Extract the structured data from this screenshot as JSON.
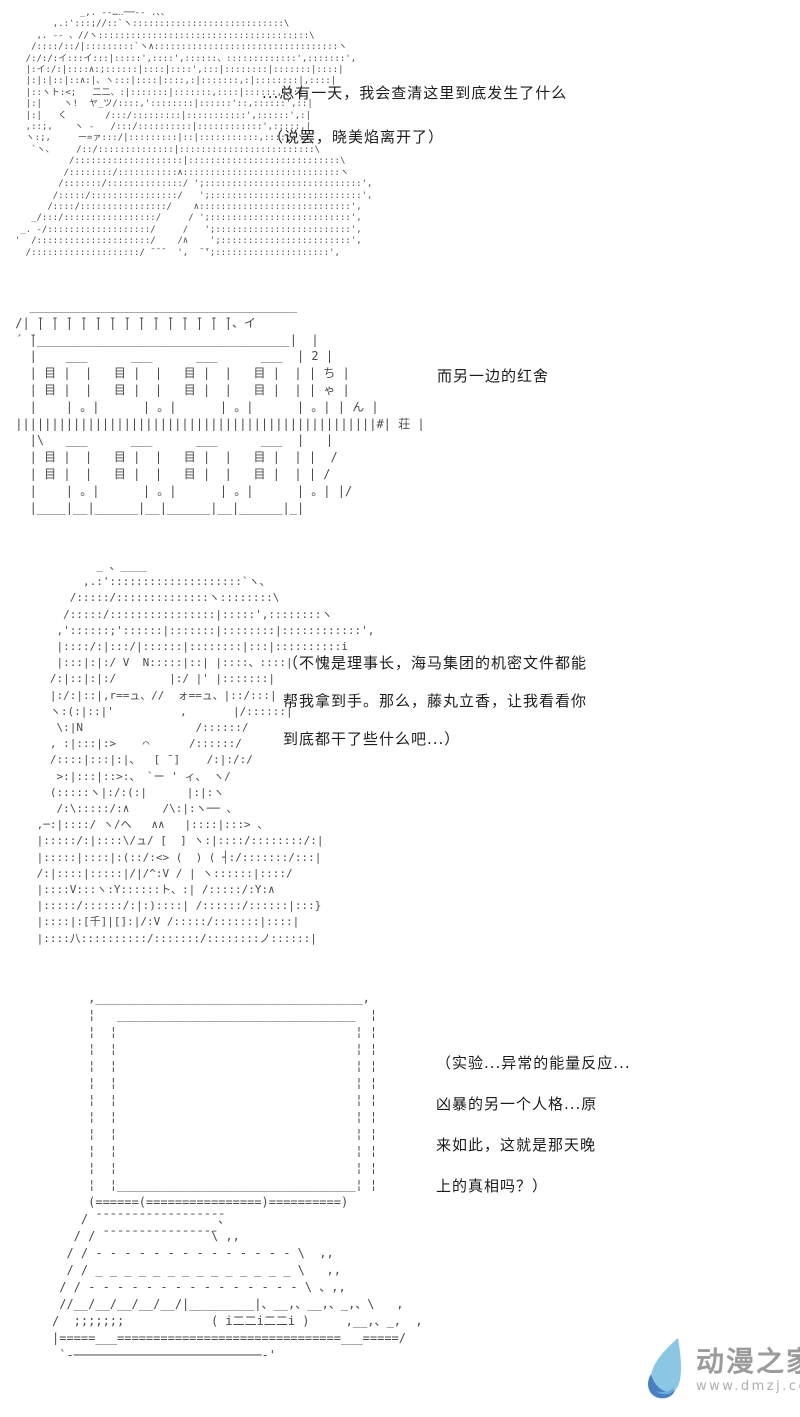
{
  "panel1": {
    "ascii": "              _,. -‐…‥──‐- .、、\n         ,.:':::;//::`ヽ::::::::::::::::::::::::::::\\\n      ,. -- 、//ヽ:::::::::::::::::::::::::::::::::::::::\\\n     /::::/::/|:::::::::`ヽ∧::::::::::::::::::::::::::::::::::ヽ\n    /:/:/:イ:::イ:::|:::::',::::',::::::、:::::::::::::',:::::::',\n    |:イ:/:|::::∧:;::::::|::::|::::',:::|::::::::|:::::::|::::|\n    |:|:|::|::∧:|、ヽ:::|::::|::::,:|:::::::,:|::::::::|,::::|\n    |::ヽト:<;   二二、:|:::::::|:::::::,::::|::::::,:::|\n    |:|    ヽ!  ヤ_ツ/::::,'::::::::|::::::'::,::::::',::|\n    |:|   く       /:::/:::::::::|:::::::::::',::::::',:|\n    ,::;,    ヽ -   /:::/::::::::::|::::::::::::',:::::,|\n    ヽ:;,     ー=ァ:::/|:::::::::|::|:::::::::::,::::::ヽ、\n     `ヽ、    /::/::::::::::::::|:::::::::::::::::::::::::\\\n            /::::::::::::::::::::|::::::::::::::::::::::::::::\\\n           /::::::::/:::::::::::∧:::::::::::::::::::::::::::::ヽ\n          /:::::::/::::::::::::::/ ';:::::::::::::::::::::::::::::',\n         /:::::/::::::::::::::::/   ';::::::::::::::::::::::::::::',\n        /::::/::::::::::::::::/    ∧::::::::::::::::::::::::::::',\n     _/:::/:::::::::::::::::/     / ';::::::::::::::::::::::::::',\n   _. -/:::::::::::::::::::/     /   ';:::::::::::::::::::::::::',\n  '  /:::::::::::::::::::::/    /∧    ';::::::::::::::::::::::::',\n    /::::::::::::::::::::/ ̄ ̄ ̄   ',  ̄ ̄';:::::::::::::::::::::',",
    "dialog_line1": "...总有一天，我会查清这里到底发生了什么",
    "dialog_line2": "（说罢，晓美焰离开了）"
  },
  "panel2": {
    "ascii": "   _____________________________________\n /| ̄| ̄| ̄| ̄| ̄| ̄| ̄| ̄| ̄| ̄| ̄| ̄| ̄| ̄|、イ\n ´ ̄|___________________________________|  |\n   |    ___      ___      ___      ___  | 2 |\n   | 目 |  |   目 |  |   目 |  |   目 |  | | ち |\n   | 目 |  |   目 |  |   目 |  |   目 |  | | ゃ |\n   |    | 。|      | 。|      | 。|      | 。| | ん |\n ||||||||||||||||||||||||||||||||||||||||||||||||||#| 荘 |\n   |\\   ___      ___      ___      ___  |   |\n   | 目 |  |   目 |  |   目 |  |   目 |  | |  /\n   | 目 |  |   目 |  |   目 |  |   目 |  | | /\n   |    | 。|      | 。|      | 。|      | 。| |/\n   |____|__|______|__|______|__|______|_|",
    "dialog_line1": "而另一边的红舍",
    "building_sign": "2ちゃん荘"
  },
  "panel3": {
    "ascii": "          _ 、____\n        ,.:'::::::::::::::::::::`ヽ、\n      /:::::/::::::::::::::ヽ::::::::\\\n     /:::::/::::::::::::::::|:::::',::::::::ヽ\n    ,'::::::;'::::::|:::::::|::::::::|::::::::::::',\n    |::::/:|:::/|::::::|::::::::|:::|::::::::::i\n    |:::|:|:/ V  Ν:::::|::| |::::、::::|\n   /:|::|:|:/        |:/ |' |:::::::|\n   |:/:|::|,r==ュ、//  ォ==ュ、|::/:::|\n   ヽ:(:|::|'          ,       |/::::::|\n    \\:|Ν                 /::::::/\n   , :|:::|:>    ⌒      /::::::/\n   /::::|:::|:|、  [ ̄ ]    /:|:/:/\n    >:|:::|::>:、 `ー ' ィ、 ヽ/\n   (:::::ヽ|:/:(:|      |:|:ヽ\n    /:\\:::::/:∧     /\\:|:ヽ── 、\n ,─:|::::/ ヽ/ヘ   ∧∧   |::::|:::> 、\n |:::::/:|::::\\/ュ/ [  ] ヽ:|::::/::::::::/:|\n |:::::|::::|:(::/:<> (  ) ( ┤:/:::::::/:::|\n /:|::::|:::::|/|/^:V / | ヽ::::::|::::/\n |::::V:::ヽ:Y::::::ト、:| /:::::/:Y:∧\n |:::::/::::::/:|:)::::| /::::::/::::::|:::}\n |::::|:[千]|[]:|/:V /:::::/:::::::|::::|\n |::::八::::::::::/:::::::/::::::::ノ::::::|",
    "dialog_lines": [
      "（不愧是理事长，海马集团的机密文件都能",
      "帮我拿到手。那么，藤丸立香，让我看看你",
      "到底都干了些什么吧...）"
    ]
  },
  "panel4": {
    "ascii": "     ,_____________________________________,\n     ¦   _________________________________  ¦\n     ¦  ¦                                 ¦ ¦\n     ¦  ¦                                 ¦ ¦\n     ¦  ¦                                 ¦ ¦\n     ¦  ¦                                 ¦ ¦\n     ¦  ¦                                 ¦ ¦\n     ¦  ¦                                 ¦ ¦\n     ¦  ¦                                 ¦ ¦\n     ¦  ¦                                 ¦ ¦\n     ¦  ¦                                 ¦ ¦\n     ¦  ¦_________________________________¦ ¦\n     (======(================)==========)\n    / ̄ ̄ ̄ ̄ ̄ ̄ ̄ ̄ ̄ ̄ ̄ ̄ ̄ ̄ ̄ ̄ ̄ ̄、\n   / / ̄ ̄ ̄ ̄ ̄ ̄ ̄ ̄ ̄ ̄ ̄ ̄ ̄ ̄ ̄ ̄\\ ,,\n  / / ‐ ‐ ‐ ‐ ‐ ‐ ‐ ‐ ‐ ‐ ‐ ‐ ‐ ‐ \\  ,,\n  / / _ _ _ _ _ _ _ _ _ _ _ _ _ _ \\   ,,\n / / ‐ ‐ ‐ ‐ ‐ ‐ ‐ ‐ ‐ ‐ ‐ ‐ ‐ ‐ ‐ \\ 、,,\n //__/__/__/__/__/|_________|、__,、__,、_,、\\   ,\n/  ;;;;;;;            ( i二二i二二i )     ,__,、_,  ,\n|=====___===============================___=====/\n `‐──────────────────────────‐'",
    "dialog_lines": [
      "（实验...异常的能量反应...",
      "凶暴的另一个人格...原",
      "来如此，这就是那天晚",
      "上的真相吗？）"
    ]
  },
  "watermark": {
    "site_name": "动漫之家",
    "site_url": "www.dmzj.com",
    "logo_color_light": "#8bc7e4",
    "logo_color_mid": "#6aaed9",
    "logo_color_dark": "#4a7fc1",
    "text_color": "#9c9c9c"
  }
}
